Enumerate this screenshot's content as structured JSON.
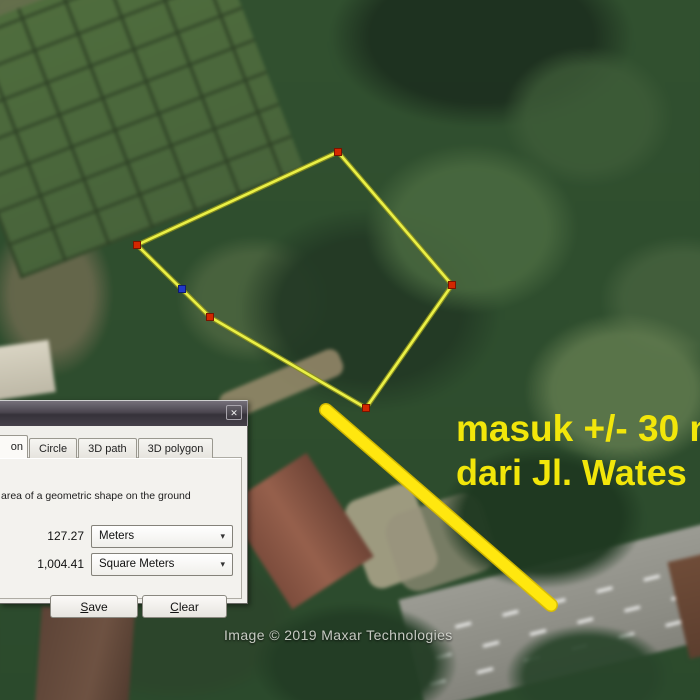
{
  "map": {
    "watermark": "Image © 2019 Maxar Technologies",
    "annotation": {
      "line1": "masuk +/- 30 m",
      "line2": "dari Jl. Wates",
      "color": "#f2e60a"
    },
    "polygon": {
      "vertices": [
        [
          338,
          152
        ],
        [
          452,
          285
        ],
        [
          366,
          408
        ],
        [
          210,
          317
        ],
        [
          137,
          245
        ]
      ],
      "midpoint": [
        182,
        289
      ],
      "stroke_color": "#eaf046",
      "halo_color": "#8a8f1e",
      "vertex_color": "#d32700",
      "midpoint_color": "#2038c8"
    },
    "measure_line": {
      "x1": 326,
      "y1": 410,
      "x2": 551,
      "y2": 605,
      "color": "#ffe70f",
      "halo_color": "#d9bd00"
    }
  },
  "dialog": {
    "tabs": [
      {
        "label": "on",
        "active": true
      },
      {
        "label": "Circle",
        "active": false
      },
      {
        "label": "3D path",
        "active": false
      },
      {
        "label": "3D polygon",
        "active": false
      }
    ],
    "description": "area of a geometric shape on the ground",
    "measurements": [
      {
        "value": "127.27",
        "unit": "Meters"
      },
      {
        "value": "1,004.41",
        "unit": "Square Meters"
      }
    ],
    "buttons": {
      "save": "Save",
      "clear": "Clear"
    },
    "icons": {
      "close": "✕",
      "dropdown": "▾"
    }
  }
}
